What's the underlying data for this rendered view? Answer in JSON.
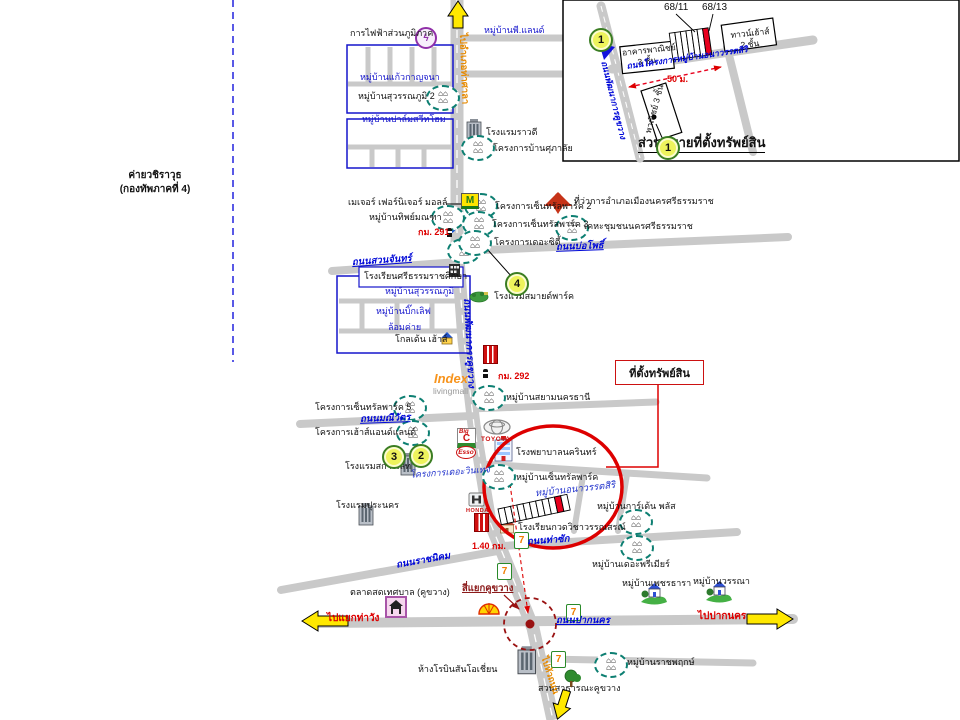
{
  "colors": {
    "road_gray": "#c9c9c9",
    "highlight_red": "#dd0000",
    "boundary_blue": "#2222dd",
    "road_label_blue": "#0008d8",
    "village_icon_teal": "#0d7f72",
    "marker_fill": "#eef35c"
  },
  "inset": {
    "title": "ส่วนขยายที่ตั้งทรัพย์สิน",
    "unit_left": "68/11",
    "unit_right": "68/13",
    "bld1a": "อาคารพาณิชย์",
    "bld1b": "3 ชั้น",
    "th1": "ทาวน์เฮ้าส์",
    "th2": "2 ชั้น",
    "bld2": "พาณิชย์ 3 ชั้น",
    "dist": "50 ม.",
    "road_main": "ถนนพัฒนาการคูขวาง",
    "road_proj": "ถนนโครงการหมู่บ้านอนาวรรตสิริ"
  },
  "roads": {
    "to_thasala": "ไปอำเภอท่าศาลา",
    "pattanakan": "ถนนพัฒนาการคูขวาง",
    "suanchan": "ถนนสวนจันทร์",
    "bopho": "ถนนบ่อโพธิ์",
    "maneewat": "ถนนมณีวัตร",
    "thasak": "ถนนท่าซัก",
    "ratnikhom": "ถนนราชนิคม",
    "paknakhon": "ถนนปากนคร",
    "to_thawang": "ไปแยกท่าวัง",
    "to_paknakhon": "ไปปากนคร",
    "to_huathanon": "ไปหัวถนน",
    "khukwang_int": "สี่แยกคูขวาง",
    "km291": "กม. 291",
    "km292": "กม. 292",
    "dist140": "1.40 กม."
  },
  "places": {
    "pea": "การไฟฟ้าส่วนภูมิภาค",
    "p_land": "หมู่บ้านพี.แลนด์",
    "kaew_kanjana": "หมู่บ้านแก้วกาญจนา",
    "suwannaphum2": "หมู่บ้านสุวรรณภูมิ 2",
    "palm_sweet_home": "หมู่บ้านปาล์มสวีทโฮม",
    "rawadee": "โรงแรมราวดี",
    "supalai": "โครงการบ้านศุภาลัย",
    "major_mall": "เมเจอร์ เฟอร์นิเจอร์ มอลล์",
    "district_office": "ที่ว่าการอำเภอเมืองนครศรีธรรมราช",
    "kheha": "เคหะชุมชนนครศรีธรรมราช",
    "central_park2": "โครงการเซ็นทรัลพาร์ค 2",
    "central_park3": "โครงการเซ็นทรัลพาร์ค 3",
    "the_city": "โครงการเดอะซิตี้",
    "thipmontha": "หมู่บ้านทิพย์มณฑา",
    "sri_school": "โรงเรียนศรีธรรมราชศึกษา",
    "suwannaphum": "หมู่บ้านสุวรรณภูมิ",
    "big_love": "หมู่บ้านบิ๊กเลิฟ",
    "lomkhai": "ล้อมค่าย",
    "golden_house": "โกลเด้น เฮ้าส์",
    "smile_park": "โรงแรมสมายด์พาร์ค",
    "siam_nakhonthani": "หมู่บ้านสยามนครธานี",
    "central_park5": "โครงการเซ็นทรัลพาร์ค 5",
    "house_and_land": "โครงการเฮ้าส์แอนด์แลนด์",
    "scarlet": "โรงแรมสการ์เลท",
    "vintage": "โครงการเดอะวินเทจ",
    "hospital": "โรงพยาบาลนครินทร์",
    "central_park_village": "หมู่บ้านเซ็นทรัลพาร์ค",
    "anawat_siri": "หมู่บ้านอนาวรรตสิริ",
    "garden_plus": "หมู่บ้านการ์เด้น พลัส",
    "premier": "หมู่บ้านเดอะพรีเมียร์",
    "wannasorn": "โรงเรียนกวดวิชาวรรณสรณ์",
    "puranakhon": "โรงแรมปุระนคร",
    "market": "ตลาดสดเทศบาล (คูขวาง)",
    "petchthara": "หมู่บ้านเพชรธารา",
    "wanna": "หมู่บ้านวรรณา",
    "robinson": "ห้างโรบินสันโอเชี่ยน",
    "ratchaphruek": "หมู่บ้านราชพฤกษ์",
    "khukwang_park": "สวนสาธารณะคูขวาง",
    "camp1": "ค่ายวชิราวุธ",
    "camp2": "(กองทัพภาคที่ 4)",
    "property_box": "ที่ตั้งทรัพย์สิน"
  },
  "brands": {
    "major": "M",
    "bigc1": "Big",
    "bigc2": "C",
    "esso": "Esso",
    "toyota": "TOYOTA",
    "honda": "HONDA",
    "seven": "7",
    "index": "Index",
    "livingmall": "livingmall",
    "pea_glyph": "ϟ"
  },
  "markers": {
    "m1": "1",
    "m2": "2",
    "m3": "3",
    "m4": "4"
  }
}
